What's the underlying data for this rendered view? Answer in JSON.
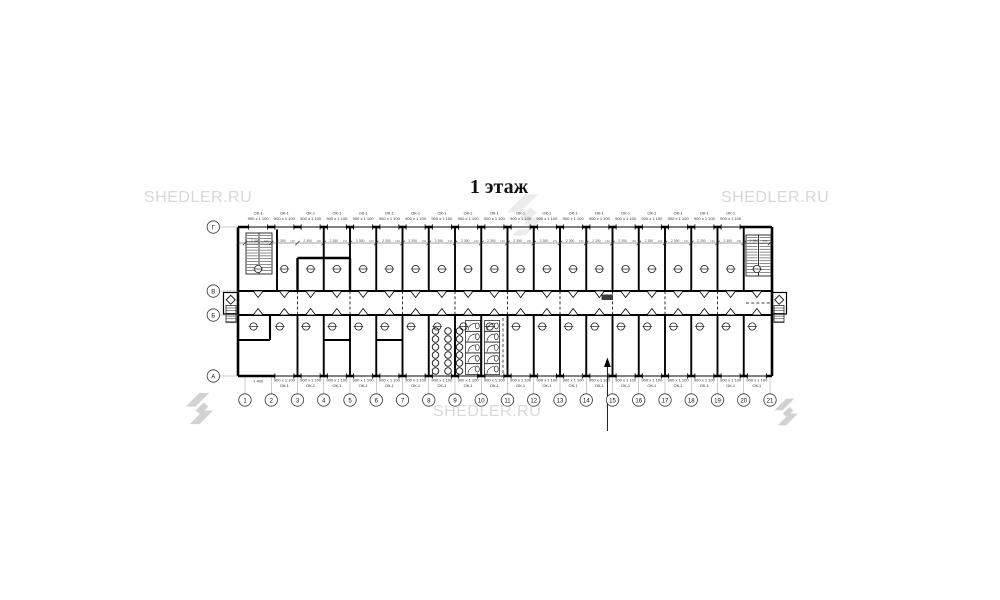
{
  "title": {
    "text": "1 этаж"
  },
  "watermark": {
    "text": "SHEDLER.RU"
  },
  "colors": {
    "wall": "#000000",
    "leader_gray": "#9a9a9a",
    "watermark_light": "#d7d7d7",
    "logo_gray": "#d2d2d2",
    "logo_faint": "#ececec",
    "corridor_tag_fill": "#3d3d3d",
    "dim_text": "#555555"
  },
  "plan": {
    "row_axes": [
      "Г",
      "В",
      "Б",
      "А"
    ],
    "col_axes": [
      "1",
      "2",
      "3",
      "4",
      "5",
      "6",
      "7",
      "8",
      "9",
      "10",
      "11",
      "12",
      "13",
      "14",
      "15",
      "16",
      "17",
      "18",
      "19",
      "20",
      "21"
    ],
    "top_windows": {
      "mark": "ОК-1",
      "size": "900 x 1 100",
      "count": 19
    },
    "bottom_windows": {
      "mark": "ОК-1",
      "size": "900 x 1 100",
      "count": 19
    },
    "dims": {
      "bay": "2 390",
      "pier": "190",
      "first_bay": "1 400"
    },
    "symbols": {
      "entrance": "diamond",
      "room_outlet": "circle-with-dash",
      "door": "wedge",
      "stairs": "hatched-flights",
      "dryer": "coil-circles",
      "wc": "stall-with-door",
      "section_cut": "arrow-line",
      "brand_logo": "double-chevron"
    }
  }
}
